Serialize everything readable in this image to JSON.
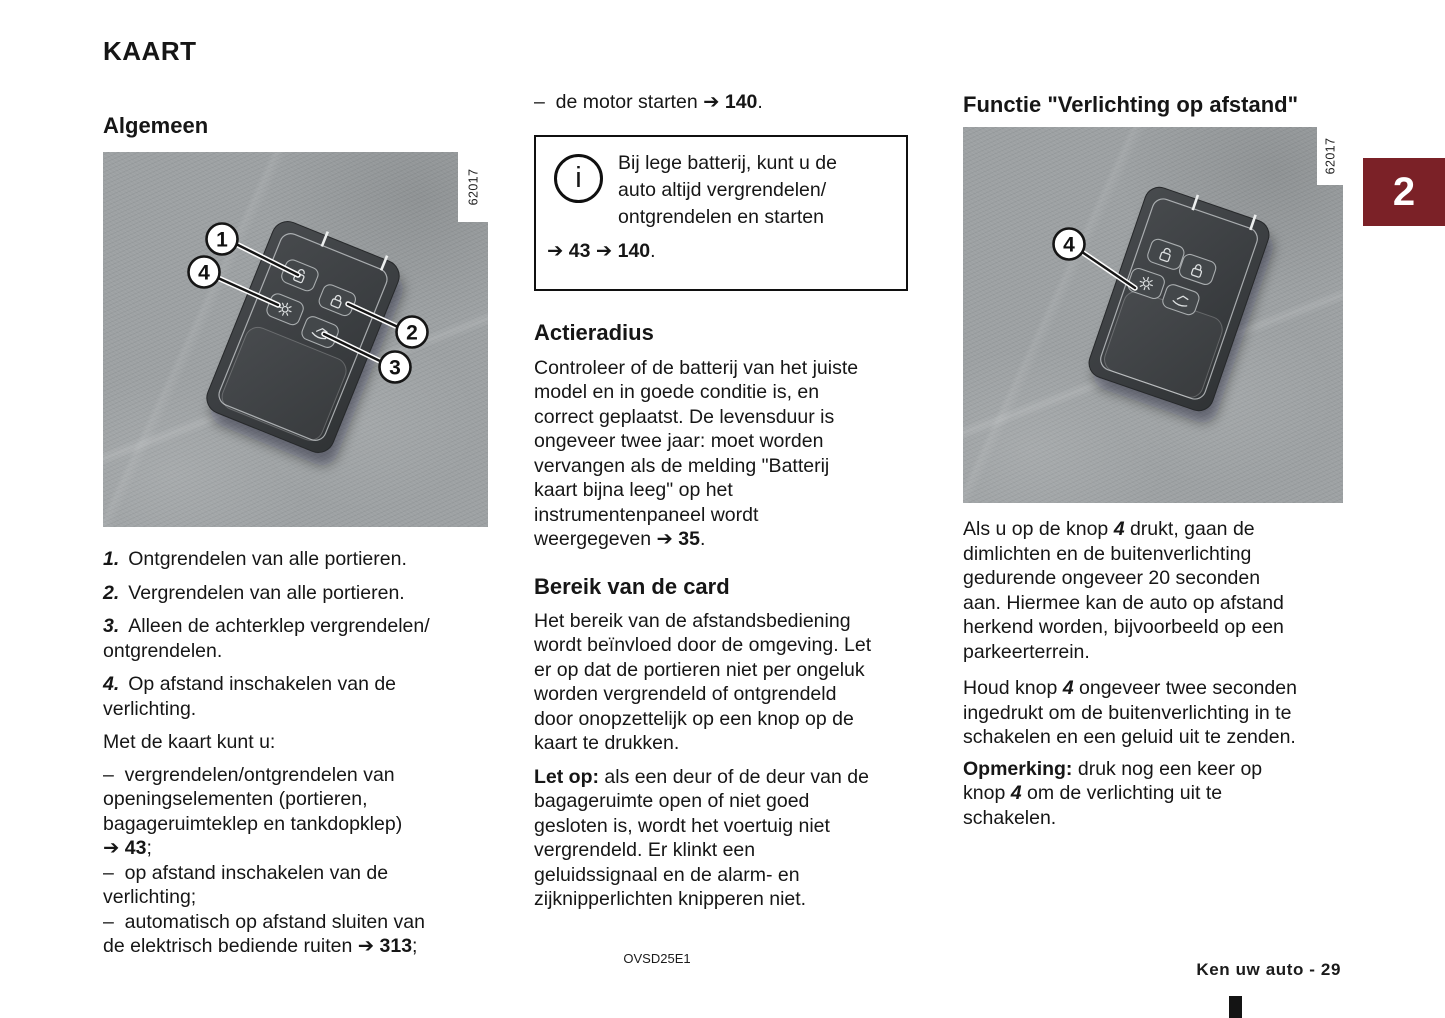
{
  "page": {
    "title": "KAART"
  },
  "chapter_tab": {
    "label": "2",
    "color": "#7b2127"
  },
  "left": {
    "section_title": "Algemeen",
    "figure": {
      "ref": "62017",
      "callouts": [
        "1",
        "4",
        "2",
        "3"
      ],
      "buttons": [
        "unlock-all-doors",
        "lock-all-doors",
        "remote-lighting",
        "tailgate-unlock"
      ]
    },
    "items": [
      {
        "num": "1.",
        "text": "Ontgrendelen van alle portieren."
      },
      {
        "num": "2.",
        "text": "Vergrendelen van alle portieren."
      },
      {
        "num": "3.",
        "text": "Alleen de achterklep vergrendelen/\nontgrendelen."
      },
      {
        "num": "4.",
        "text": "Op afstand inschakelen van de\nverlichting."
      }
    ],
    "intro": "Met de kaart kunt u:",
    "bullets": [
      "–  vergrendelen/ontgrendelen van\nopeningselementen (portieren,\nbagageruimteklep en tankdopklep)\n**➔ 43**;",
      "–  op afstand inschakelen van de\nverlichting;",
      "–  automatisch op afstand sluiten van\nde elektrisch bediende ruiten **➔ 313**;"
    ]
  },
  "middle": {
    "top_line": "–  de motor starten **➔ 140**.",
    "info_box": {
      "icon_glyph": "i",
      "text": "Bij lege batterij, kunt u de\nauto altijd vergrendelen/\nontgrendelen en starten",
      "refs": "**➔ 43 ➔ 140**."
    },
    "sections": [
      {
        "title": "Actieradius",
        "body": "Controleer of de batterij van het juiste\nmodel en in goede conditie is, en\ncorrect geplaatst. De levensduur is\nongeveer twee jaar: moet worden\nvervangen als de melding \"Batterij\nkaart bijna leeg\" op het\ninstrumentenpaneel wordt\nweergegeven **➔ 35**."
      },
      {
        "title": "Bereik van de card",
        "body": "Het bereik van de afstandsbediening\nwordt beïnvloed door de omgeving. Let\ner op dat de portieren niet per ongeluk\nworden vergrendeld of ontgrendeld\ndoor onopzettelijk op een knop op de\nkaart te drukken."
      }
    ],
    "note": "**Let op:** als een deur of de deur van de\nbagageruimte open of niet goed\ngesloten is, wordt het voertuig niet\nvergrendeld. Er klinkt een\ngeluidssignaal en de alarm- en\nzijknipperlichten knipperen niet."
  },
  "right": {
    "section_title": "Functie \"Verlichting op afstand\"",
    "figure": {
      "ref": "62017",
      "callouts": [
        "4"
      ],
      "buttons": [
        "unlock-all-doors",
        "lock-all-doors",
        "remote-lighting",
        "tailgate-unlock"
      ]
    },
    "paragraphs": [
      "Als u op de knop //4// drukt, gaan de\ndimlichten en de buitenverlichting\ngedurende ongeveer 20 seconden\naan. Hiermee kan de auto op afstand\nherkend worden, bijvoorbeeld op een\nparkeerterrein.",
      "Houd knop //4// ongeveer twee seconden\ningedrukt om de buitenverlichting in te\nschakelen en een geluid uit te zenden.",
      "**Opmerking:** druk nog een keer op\nknop //4// om de verlichting uit te\nschakelen."
    ]
  },
  "footer": {
    "doc_code": "OVSD25E1",
    "page_label": "Ken uw auto - 29"
  },
  "colors": {
    "tab_red": "#7b2127",
    "figure_background": "#9da1a3",
    "keycard_body": "#3c4043",
    "text": "#161616"
  }
}
